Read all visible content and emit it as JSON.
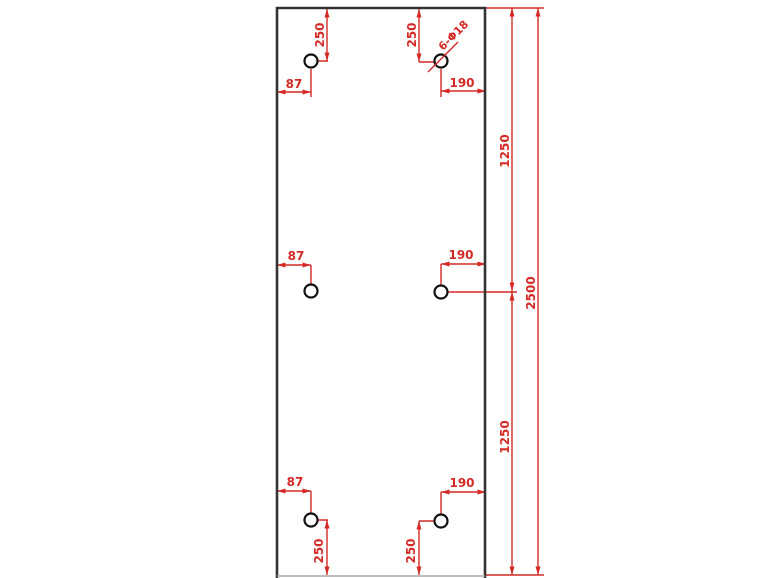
{
  "drawing": {
    "type": "cad-plate-drawing",
    "hole_count": 6,
    "colors": {
      "dimension_red": "#d42a26",
      "outline_dark": "#333333",
      "hole_stroke": "#111111",
      "background": "#ffffff"
    },
    "labels": {
      "top_left_vertical_250": "250",
      "top_right_vertical_250": "250",
      "top_left_horizontal_87": "87",
      "top_right_horizontal_190": "190",
      "hole_callout": "6-Φ18",
      "right_upper_1250": "1250",
      "right_overall_2500": "2500",
      "right_lower_1250": "1250",
      "mid_left_horizontal_87": "87",
      "mid_right_horizontal_190": "190",
      "bottom_left_horizontal_87": "87",
      "bottom_right_horizontal_190": "190",
      "bottom_left_vertical_250": "250",
      "bottom_right_vertical_250": "250"
    }
  }
}
